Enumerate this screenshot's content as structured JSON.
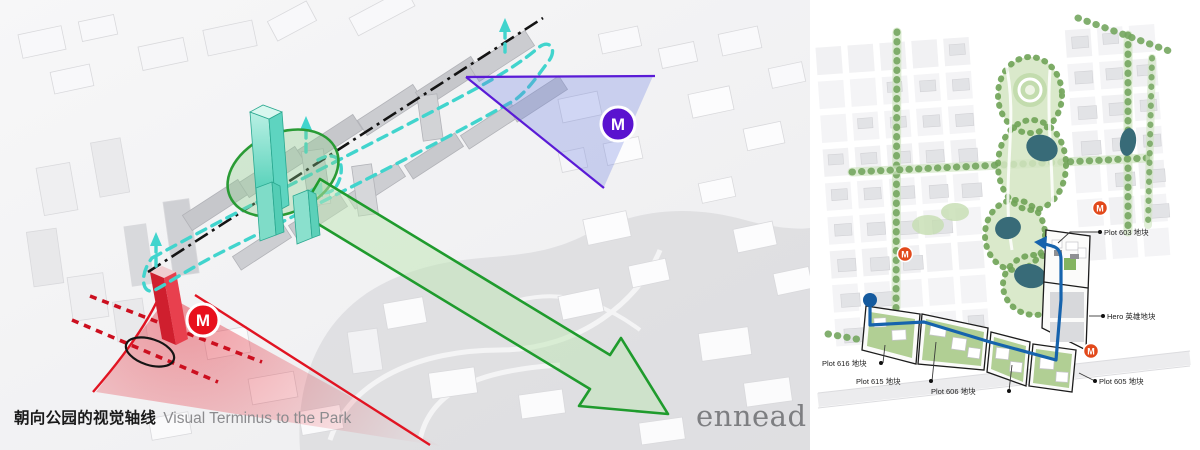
{
  "caption": {
    "zh": "朝向公园的视觉轴线",
    "en": "Visual Terminus to the Park"
  },
  "logo_text": "ennead",
  "left_diagram": {
    "metro_label": "M",
    "colors": {
      "cyan_route": "#41d4cd",
      "axis_black": "#141414",
      "view_green": "#1f9b2d",
      "view_purple": "#5a1bd6",
      "view_red": "#e11422",
      "metro_purple_fill": "#5a13cf",
      "metro_red_fill": "#e8111d"
    }
  },
  "site_plan": {
    "metro_label": "M",
    "metro_color": "#e2491b",
    "route_color": "#1663ad",
    "pond_color": "#386b78",
    "plot_labels": [
      "Plot 603 地块",
      "Hero 英雄地块",
      "Plot 605 地块",
      "Plot 606 地块",
      "Plot 615 地块",
      "Plot 616 地块"
    ]
  }
}
